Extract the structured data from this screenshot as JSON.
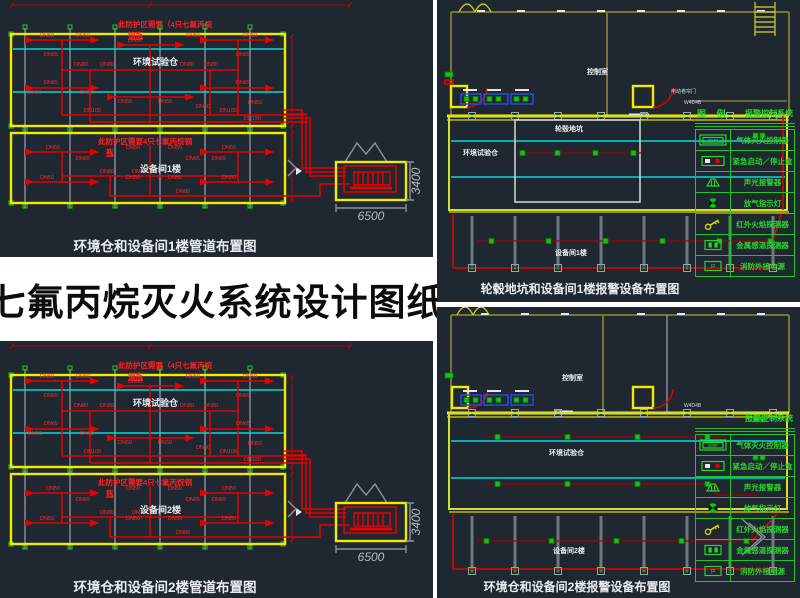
{
  "title": {
    "text": "七氟丙烷灭火系统设计图纸"
  },
  "legend": {
    "title_left": "图 例",
    "title_right": "报警控制系统",
    "controller_text": "GMP",
    "power_text": "P",
    "rows": [
      {
        "icon": "icon-gas-extinguish-controller",
        "label": "气体灭火控制器"
      },
      {
        "icon": "icon-emergency-start-stop-box",
        "label": "紧急启动／停止盒"
      },
      {
        "icon": "icon-sound-light-alarm",
        "label": "声光报警器"
      },
      {
        "icon": "icon-gas-release-indicator",
        "label": "放气指示灯"
      },
      {
        "icon": "icon-infrared-flame-detector",
        "label": "红外火焰探测器"
      },
      {
        "icon": "icon-metal-heat-detector",
        "label": "金属感温探测器"
      },
      {
        "icon": "icon-fire-external-power",
        "label": "消防外接电源"
      }
    ]
  },
  "pipe_plan": {
    "note_upper_line1": "此防护区需要（4只七氟丙烷",
    "note_upper_line2": "钢瓶",
    "note_lower_line1": "此防护区需要4只七氟丙烷钢",
    "note_lower_line2": "瓶",
    "room_upper": "环境试验仓",
    "dim_width": "6500",
    "dim_height": "3400",
    "labels_upper": [
      {
        "t": "DN50",
        "x": 40,
        "y": 37
      },
      {
        "t": "DN50",
        "x": 76,
        "y": 37
      },
      {
        "t": "DN50",
        "x": 128,
        "y": 42
      },
      {
        "t": "DN50",
        "x": 186,
        "y": 37
      },
      {
        "t": "DN50",
        "x": 243,
        "y": 37
      },
      {
        "t": "DN65",
        "x": 44,
        "y": 56
      },
      {
        "t": "DN65",
        "x": 236,
        "y": 56
      },
      {
        "t": "DN80",
        "x": 74,
        "y": 66
      },
      {
        "t": "DN80",
        "x": 100,
        "y": 66
      },
      {
        "t": "DN80",
        "x": 180,
        "y": 66
      },
      {
        "t": "DN80",
        "x": 204,
        "y": 66
      },
      {
        "t": "DN65",
        "x": 44,
        "y": 84
      },
      {
        "t": "DN65",
        "x": 236,
        "y": 84
      },
      {
        "t": "DN50",
        "x": 28,
        "y": 94
      },
      {
        "t": "DN50",
        "x": 80,
        "y": 94
      },
      {
        "t": "DN50",
        "x": 118,
        "y": 103
      },
      {
        "t": "DN50",
        "x": 158,
        "y": 103
      },
      {
        "t": "DN50",
        "x": 196,
        "y": 108
      },
      {
        "t": "DN50",
        "x": 248,
        "y": 104
      },
      {
        "t": "DN100",
        "x": 84,
        "y": 112
      },
      {
        "t": "DN100",
        "x": 220,
        "y": 112
      },
      {
        "t": "DN150",
        "x": 244,
        "y": 120
      }
    ],
    "labels_lower": [
      {
        "t": "DN50",
        "x": 46,
        "y": 149
      },
      {
        "t": "DN50",
        "x": 126,
        "y": 149
      },
      {
        "t": "DN50",
        "x": 168,
        "y": 149
      },
      {
        "t": "DN50",
        "x": 222,
        "y": 149
      },
      {
        "t": "DN65",
        "x": 76,
        "y": 160
      },
      {
        "t": "DN65",
        "x": 186,
        "y": 160
      },
      {
        "t": "DN65",
        "x": 212,
        "y": 160
      },
      {
        "t": "DN80",
        "x": 100,
        "y": 173
      },
      {
        "t": "DN80",
        "x": 132,
        "y": 173
      },
      {
        "t": "DN50",
        "x": 40,
        "y": 179
      },
      {
        "t": "DN50",
        "x": 126,
        "y": 179
      },
      {
        "t": "DN50",
        "x": 168,
        "y": 179
      },
      {
        "t": "DN50",
        "x": 222,
        "y": 179
      },
      {
        "t": "DN80",
        "x": 176,
        "y": 193
      }
    ]
  },
  "panel_tl": {
    "caption": "环境仓和设备间1楼管道布置图",
    "room_lower": "设备间1楼"
  },
  "panel_bl": {
    "caption": "环境仓和设备间2楼管道布置图",
    "room_lower": "设备间2楼"
  },
  "panel_tr": {
    "caption": "轮毂地坑和设备间1楼报警设备布置图",
    "room_control": "控制室",
    "room_chamber": "环境试验仓",
    "room_pit": "轮毂地坑",
    "room_equipment": "设备间1楼",
    "door_note": "电动卷帘门",
    "tag": "W4D4B"
  },
  "panel_br": {
    "caption": "环境仓和设备间2楼报警设备布置图",
    "room_control": "控制室",
    "room_chamber": "环境试验仓",
    "room_equipment": "设备间2楼",
    "tag": "W4D4B"
  },
  "colors": {
    "panel_bg": "#1f2731",
    "pipe_red": "#e60000",
    "cyan": "#00dcdc",
    "wall_yellow": "#f2ea00",
    "legend_green": "#22d422"
  }
}
